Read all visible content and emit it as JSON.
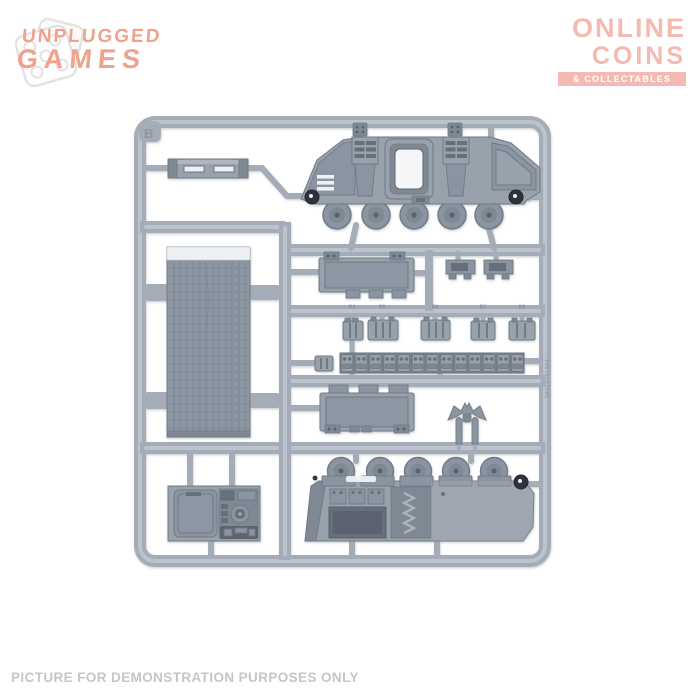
{
  "header": {
    "unplugged": {
      "line1": "UNPLUGGED",
      "line2": "GAMES",
      "color": "#f0a28d",
      "die_color": "#e3e3e3"
    },
    "online": {
      "line1": "ONLINE",
      "line2": "COINS",
      "banner": "& COLLECTABLES",
      "color": "#f4bab2",
      "banner_text_color": "#ffffff"
    }
  },
  "footer": {
    "text": "PICTURE FOR DEMONSTRATION PURPOSES ONLY",
    "color": "#c6c6c6"
  },
  "sprue": {
    "frame_letter": "B",
    "mold_code": "99370101004",
    "track_labels": [
      "R4",
      "R5",
      "R6",
      "R7",
      "R8"
    ],
    "colors": {
      "runner": "#a4acb7",
      "runner_light": "#bcc3cc",
      "part": "#98a2ad",
      "part_mid": "#8b95a1",
      "part_light": "#aeb7c1",
      "part_dark": "#7f8994",
      "edge": "#6f7985",
      "recess": "#666f7a",
      "recess_dark": "#5b646f",
      "deep": "#2d333a",
      "white_detail": "#eef1f4",
      "panel": "#8d97a3"
    }
  }
}
